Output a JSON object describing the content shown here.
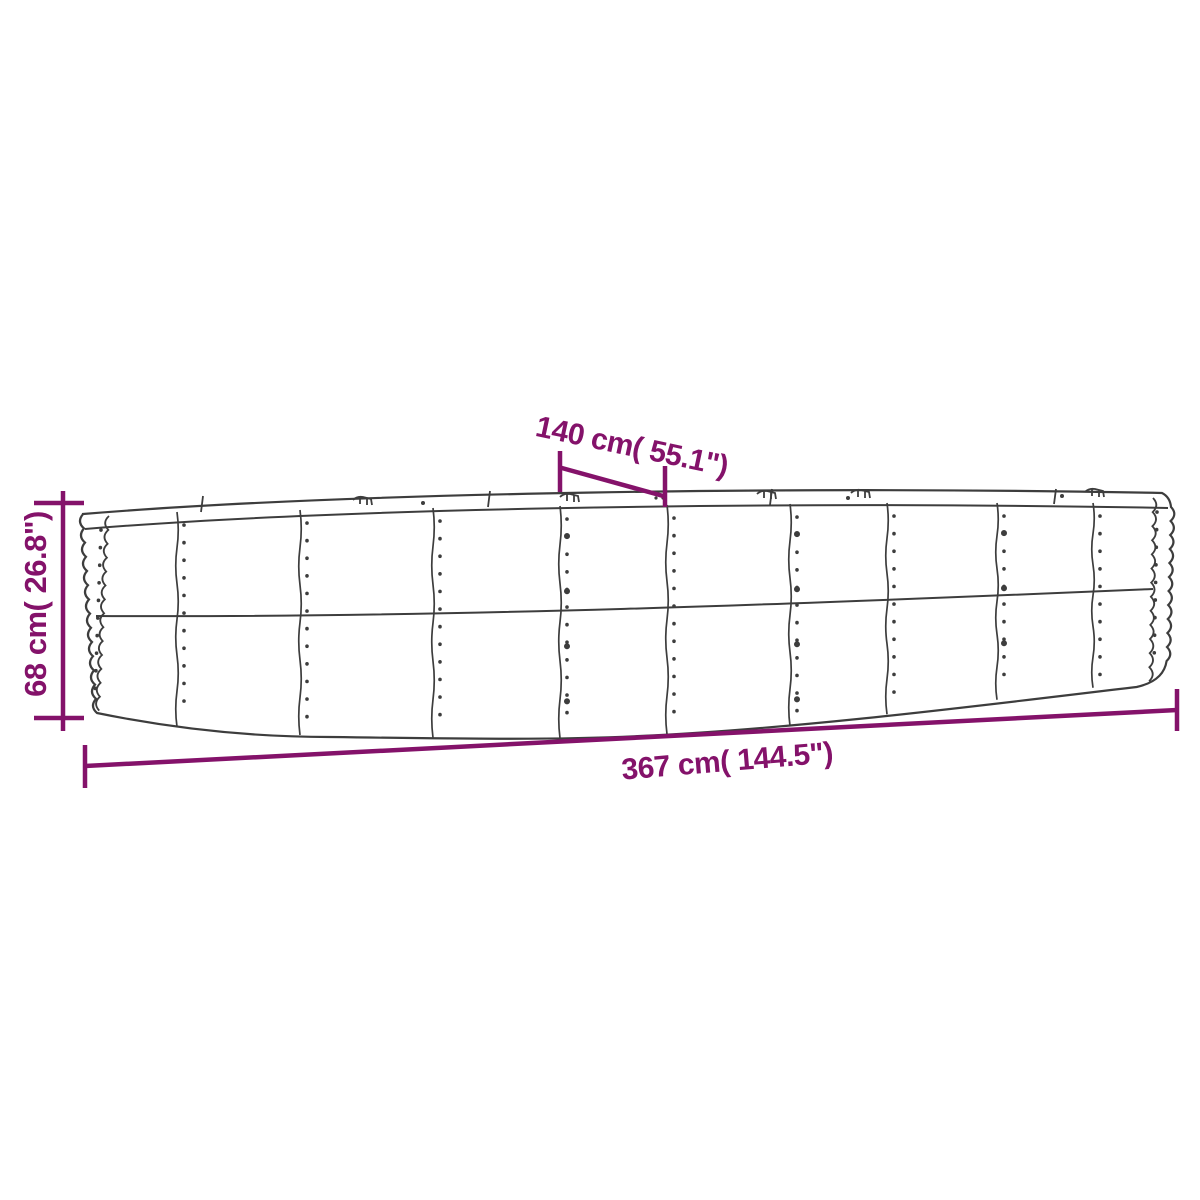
{
  "diagram": {
    "kind": "product-dimension-drawing",
    "dimensions": {
      "depth": {
        "label": "140 cm( 55.1\")"
      },
      "height": {
        "label": "68 cm( 26.8\")"
      },
      "length": {
        "label": "367 cm( 144.5\")"
      }
    }
  },
  "colors": {
    "dimension": "#84126A",
    "outline": "#3d3d3d",
    "background": "#ffffff"
  }
}
